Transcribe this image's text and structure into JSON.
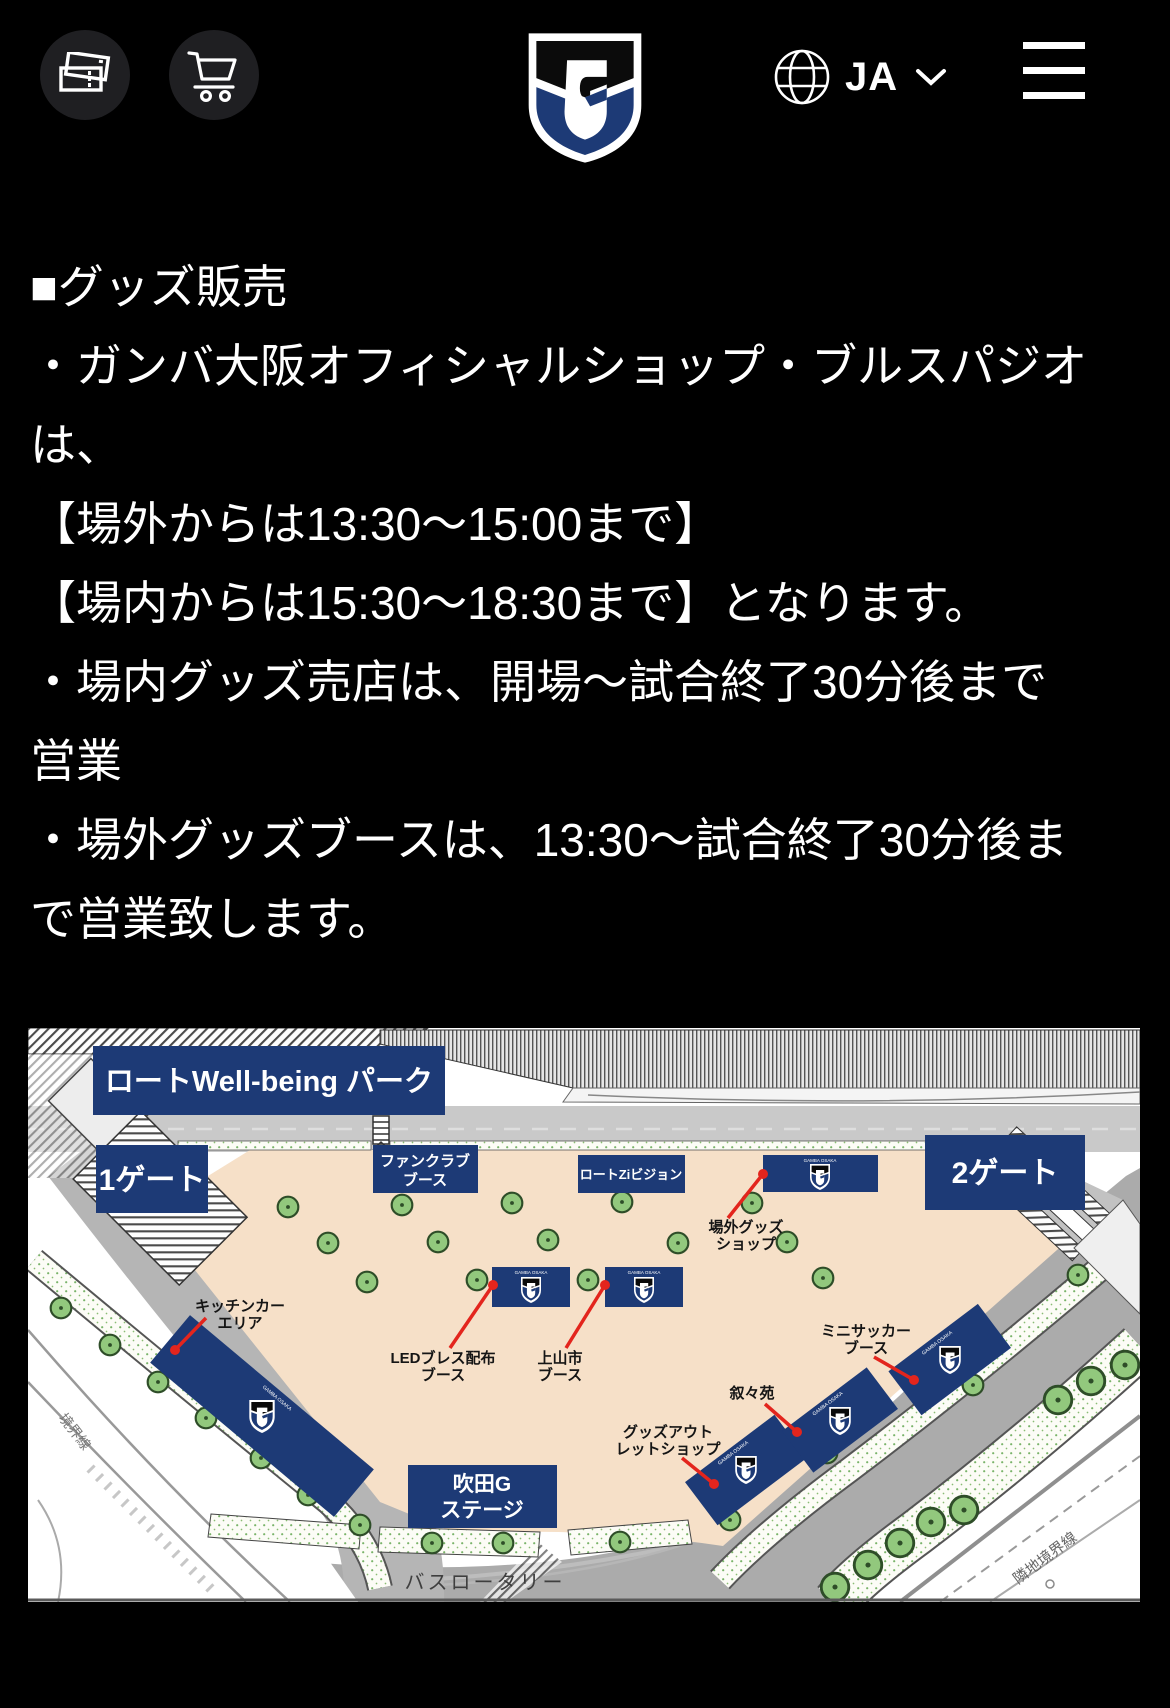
{
  "header": {
    "language": "JA",
    "icons": {
      "tickets": "ticket-icon",
      "cart": "cart-icon",
      "globe": "globe-icon",
      "menu": "hamburger-icon"
    }
  },
  "content": {
    "paragraphs": [
      "■グッズ販売",
      "・ガンバ大阪オフィシャルショップ・ブルスパジオは、",
      "【場外からは13:30～15:00まで】",
      "【場内からは15:30～18:30まで】となります。",
      "・場内グッズ売店は、開場～試合終了30分後まで営業",
      "・場外グッズブースは、13:30～試合終了30分後まで営業致します。"
    ]
  },
  "map": {
    "banner": "ロートWell-being パーク",
    "gate1": "1ゲート",
    "gate2": "2ゲート",
    "fanclub_l1": "ファンクラブ",
    "fanclub_l2": "ブース",
    "zivision": "ロートZiビジョン",
    "goods_shop_l1": "場外グッズ",
    "goods_shop_l2": "ショップ",
    "kitchen_l1": "キッチンカー",
    "kitchen_l2": "エリア",
    "led_l1": "LEDブレス配布",
    "led_l2": "ブース",
    "kaminoyama_l1": "上山市",
    "kaminoyama_l2": "ブース",
    "minisoccer_l1": "ミニサッカー",
    "minisoccer_l2": "ブース",
    "jojoen": "叙々苑",
    "outlet_l1": "グッズアウト",
    "outlet_l2": "レットショップ",
    "suita_l1": "吹田G",
    "suita_l2": "ステージ",
    "bus_rotary": "バスロータリー",
    "boundary_left": "境界線",
    "boundary_right": "隣地境界線",
    "booth_brand": "GAMBA OSAKA"
  },
  "colors": {
    "page_bg": "#000000",
    "accent_navy": "#1d3a76",
    "plaza": "#f6e0c8",
    "tree_green": "#92c87d",
    "annotation_red": "#e3251d"
  }
}
